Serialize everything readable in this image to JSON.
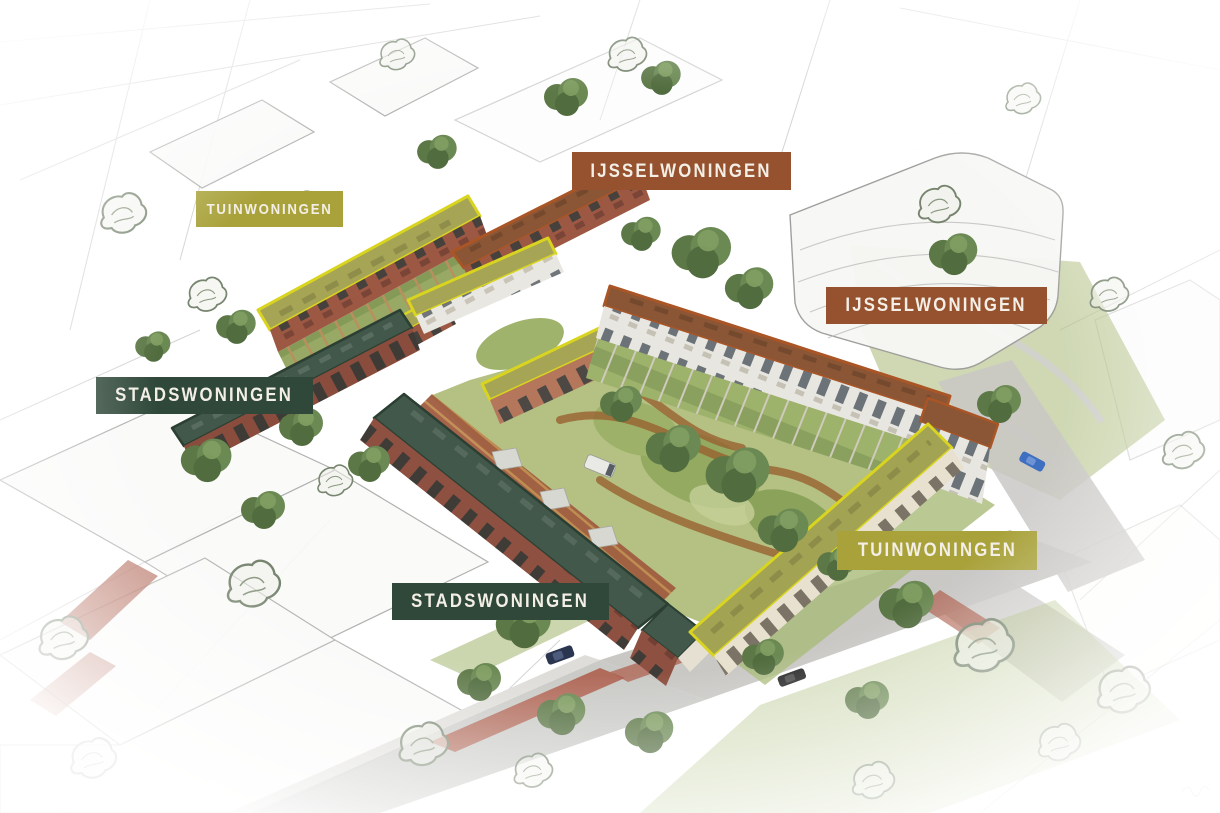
{
  "scene": {
    "kind": "aerial-masterplan-rendering",
    "description": "Bird's-eye architectural rendering of a housing block with labeled dwelling types, surrounded by sketched context buildings"
  },
  "housing_types": [
    {
      "name": "TUINWONINGEN",
      "label_color": "#a9a23b",
      "roof_outline": "#d9d41f",
      "roof_fill": "#a6a556"
    },
    {
      "name": "IJSSELWONINGEN",
      "label_color": "#96512e",
      "roof_outline": "#aa5526",
      "roof_fill": "#8a5636"
    },
    {
      "name": "STADSWONINGEN",
      "label_color": "#2f4839",
      "roof_outline": "#2b3f33",
      "roof_fill": "#42584a"
    }
  ],
  "labels": [
    {
      "text": "TUINWONINGEN",
      "color": "#a9a23b"
    },
    {
      "text": "IJSSELWONINGEN",
      "color": "#96512e"
    },
    {
      "text": "IJSSELWONINGEN",
      "color": "#96512e"
    },
    {
      "text": "STADSWONINGEN",
      "color": "#2f4839"
    },
    {
      "text": "STADSWONINGEN",
      "color": "#2f4839"
    },
    {
      "text": "TUINWONINGEN",
      "color": "#a9a23b"
    }
  ],
  "palette": {
    "brick": "#9c5843",
    "brick_dark": "#8a4c3c",
    "brick_light": "#b5775c",
    "facade_white": "#e9e7e1",
    "facade_cream": "#e8e1cf",
    "lawn": "#b4c183",
    "lawn_dark": "#93aa60",
    "path_rust": "#99602f",
    "paving": "#a05c40",
    "wood": "#c08a4f",
    "road": "#c6c5c2",
    "bike_lane_red": "#ad5b48",
    "sketch_line": "#9a9a9a",
    "tree_green": "#6b8953"
  }
}
